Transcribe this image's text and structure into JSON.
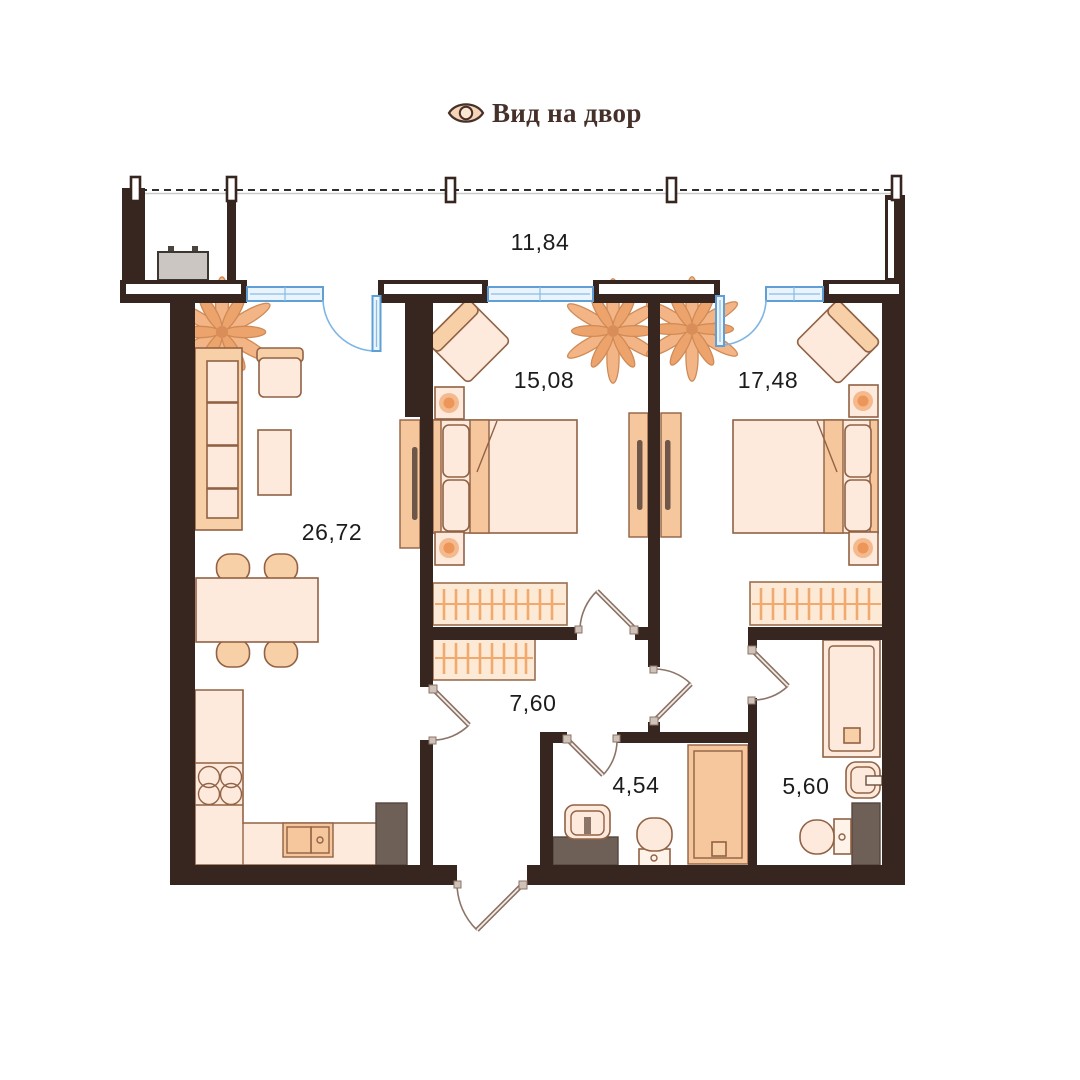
{
  "header": {
    "icon": "eye-icon",
    "label": "Вид на двор"
  },
  "rooms": [
    {
      "name": "balcony",
      "area": "11,84"
    },
    {
      "name": "living-room-kitchen",
      "area": "26,72"
    },
    {
      "name": "bedroom-1",
      "area": "15,08"
    },
    {
      "name": "bedroom-2",
      "area": "17,48"
    },
    {
      "name": "hallway",
      "area": "7,60"
    },
    {
      "name": "bathroom-1",
      "area": "4,54"
    },
    {
      "name": "bathroom-2",
      "area": "5,60"
    }
  ],
  "colors": {
    "wall": "#372620",
    "window_blue": "#5f9fd6",
    "furniture_light": "#fdeadc",
    "furniture_mid": "#f8d0a8",
    "accent_orange": "#ec9659",
    "dark_fixture": "#6f6057",
    "door_arc": "#8d7468",
    "label_text": "#1c1c1c",
    "header_text": "#46302a"
  }
}
